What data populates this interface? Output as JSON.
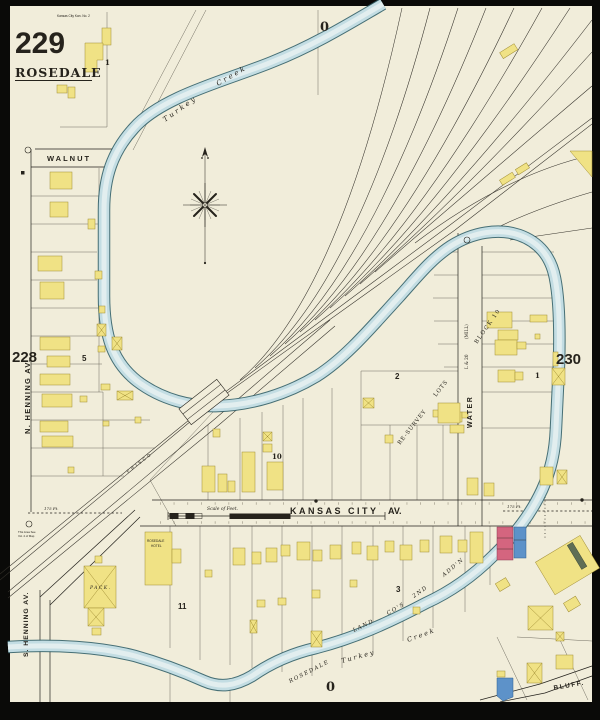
{
  "colors": {
    "paper": "#f1edda",
    "ink": "#26231c",
    "photo": "#0a0a08",
    "creekdark": "#336169",
    "creeklight": "#c3dde3",
    "creekpale": "#e6efef",
    "frame": "#f0e285",
    "framestroke": "#a08d33",
    "brick": "#d4657f",
    "brickstroke": "#8d3a54",
    "stone": "#5d92c9",
    "stonestroke": "#2f5e8f"
  },
  "titleblock": {
    "sheet_number": "229",
    "header_note": "Kansas City Kan. No. 2",
    "city_name": "ROSEDALE"
  },
  "adjacent_sheets": {
    "left": "228",
    "right": "230",
    "top": "0",
    "bottom": "0"
  },
  "streets": {
    "walnut": "WALNUT",
    "n_henning": "N. HENNING AV.",
    "s_henning": "S. HENNING AV.",
    "kansas_city": "KANSAS CITY",
    "kc_av": "AV.",
    "water": "WATER",
    "mill": "(MILL)",
    "mill_lot": "L & 20",
    "bluff": "BLUFF."
  },
  "railroad": {
    "name": "FRISCO"
  },
  "creek": {
    "upper": [
      "Turkey",
      "Creek"
    ],
    "lower": [
      "Turkey",
      "Creek"
    ]
  },
  "subdivision": {
    "resurvey": "RE-SURVEY",
    "resurvey_lots": "LOTS",
    "block10_text": "BLOCK 10",
    "land_co": [
      "ROSEDALE",
      "LAND",
      "CO'S",
      "2ND",
      "ADD'N"
    ]
  },
  "blocks": {
    "top_block": "1",
    "block5": "5",
    "block2": "2",
    "block10": "10",
    "block1_right": "1",
    "block11": "11",
    "block3": "3"
  },
  "buildings": {
    "pack": "PACK.",
    "hotel_line1": "ROSEDALE",
    "hotel_line2": "HOTEL"
  },
  "annotations": {
    "scale": "Scale of Feet.",
    "width_left": "175 Ft.",
    "width_right": "175 Ft.",
    "note_line1": "This Area See",
    "note_line2": "Vol. 2 of Map"
  }
}
